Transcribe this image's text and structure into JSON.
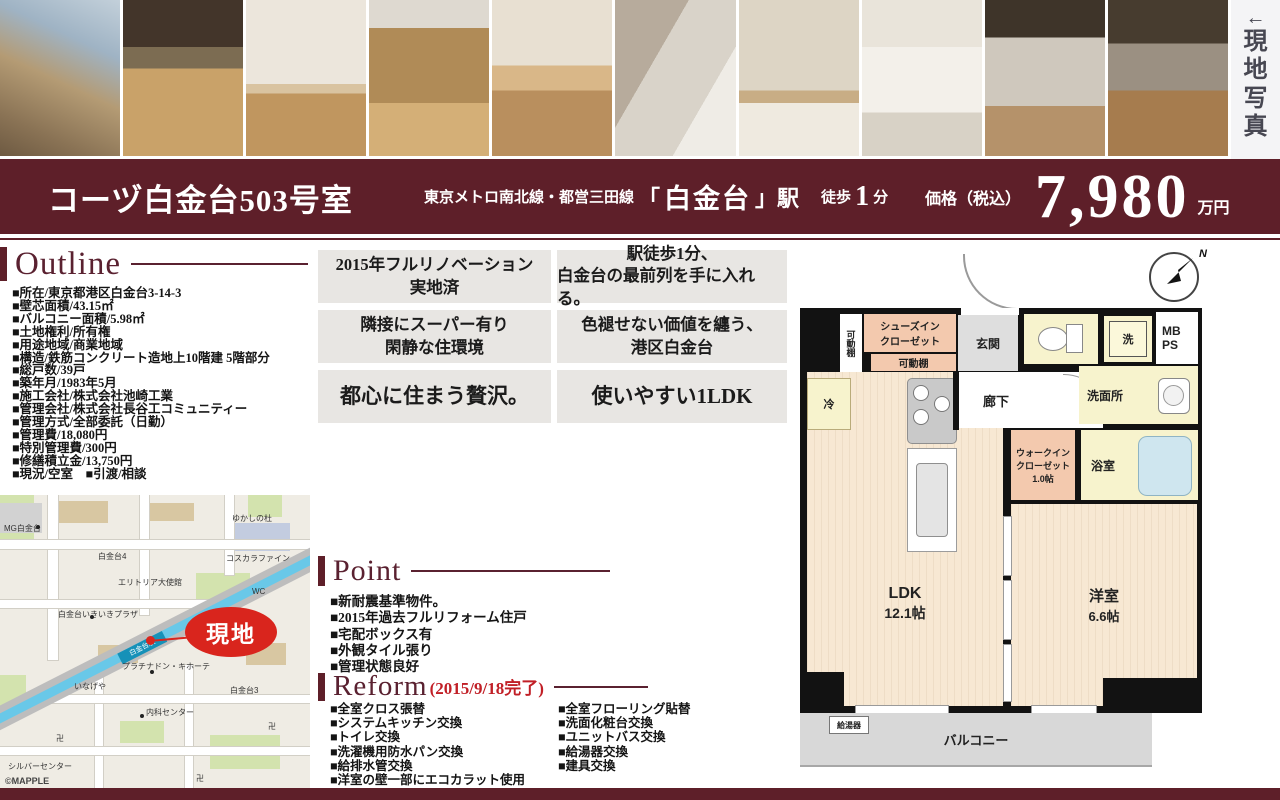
{
  "photo_panel": {
    "arrow": "←",
    "side_chars": [
      "現",
      "地",
      "写",
      "真"
    ]
  },
  "header": {
    "title": "コーヅ白金台503号室",
    "lines": "東京メトロ南北線・都営三田線",
    "bracket_open": "「",
    "station_name": "白金台",
    "bracket_close": "」駅",
    "walk_label": "徒歩",
    "walk_minutes": "1",
    "walk_unit": "分",
    "price_label": "価格（税込）",
    "price_value": "7,980",
    "price_unit": "万円"
  },
  "outline": {
    "heading": "Outline",
    "items": [
      "■所在/東京都港区白金台3-14-3",
      "■壁芯面積/43.15㎡",
      "■バルコニー面積/5.98㎡",
      "■土地権利/所有権",
      "■用途地域/商業地域",
      "■構造/鉄筋コンクリート造地上10階建 5階部分",
      "■総戸数/39戸",
      "■築年月/1983年5月",
      "■施工会社/株式会社池崎工業",
      "■管理会社/株式会社長谷工コミュニティー",
      "■管理方式/全部委託（日勤）",
      "■管理費/18,080円",
      "■特別管理費/300円",
      "■修繕積立金/13,750円",
      "■現況/空室　■引渡/相談"
    ]
  },
  "features": {
    "boxes": [
      {
        "line1": "2015年フルリノベーション",
        "line2": "実地済"
      },
      {
        "line1": "駅徒歩1分、",
        "line2": "白金台の最前列を手に入れる。"
      },
      {
        "line1": "隣接にスーパー有り",
        "line2": "閑静な住環境"
      },
      {
        "line1": "色褪せない価値を纏う、",
        "line2": "港区白金台"
      },
      {
        "line1": "都心に住まう贅沢。"
      },
      {
        "line1": "使いやすい1LDK"
      }
    ]
  },
  "point": {
    "heading": "Point",
    "items": [
      "■新耐震基準物件。",
      "■2015年過去フルリフォーム住戸",
      "■宅配ボックス有",
      "■外観タイル張り",
      "■管理状態良好"
    ]
  },
  "reform": {
    "heading": "Reform",
    "note": "(2015/9/18完了)",
    "left": [
      "■全室クロス張替",
      "■システムキッチン交換",
      "■トイレ交換",
      "■洗濯機用防水パン交換",
      "■給排水管交換",
      "■洋室の壁一部にエコカラット使用"
    ],
    "right": [
      "■全室フローリング貼替",
      "■洗面化粧台交換",
      "■ユニットバス交換",
      "■給湯器交換",
      "■建具交換"
    ]
  },
  "floorplan": {
    "compass_n": "N",
    "movable_shelf_v": "可動棚",
    "shoes_closet_l1": "シューズイン",
    "shoes_closet_l2": "クローゼット",
    "movable_shelf_h": "可動棚",
    "entrance": "玄関",
    "washer": "洗",
    "mb": "MB",
    "ps": "PS",
    "hallway": "廊下",
    "washroom": "洗面所",
    "fridge": "冷",
    "wic_l1": "ウォークイン",
    "wic_l2": "クローゼット",
    "wic_l3": "1.0帖",
    "bathroom": "浴室",
    "ldk_l1": "LDK",
    "ldk_l2": "12.1帖",
    "bedroom_l1": "洋室",
    "bedroom_l2": "6.6帖",
    "balcony": "バルコニー",
    "water_heater": "給湯器"
  },
  "map": {
    "mg_shirokanedai": "MG白金台",
    "shirokanedai4": "白金台4",
    "yukashinomori": "ゆかしの杜",
    "kosukara": "コスカラファイン",
    "embassy": "エリトリア大使館",
    "ikiiki_plaza": "白金台いきいきプラザ",
    "station": "白金台駅",
    "wc": "WC",
    "donki": "プラチナドン・キホーテ",
    "inageya": "いなげや",
    "shirokanedai3": "白金台3",
    "naika": "内科センター",
    "silver_center": "シルバーセンター",
    "temple": "卍",
    "genchi": "現地",
    "mapple": "©MAPPLE"
  },
  "colors": {
    "maroon": "#5e1f29",
    "accent_red": "#c11f26",
    "genchi_red": "#d9251d",
    "feature_gray": "#e8e6e3",
    "room_cream": "#f7e8d3",
    "closet_pink": "#f3c9ae",
    "wet_yellow": "#f7f3cd",
    "metro_blue": "#69c8e8"
  }
}
